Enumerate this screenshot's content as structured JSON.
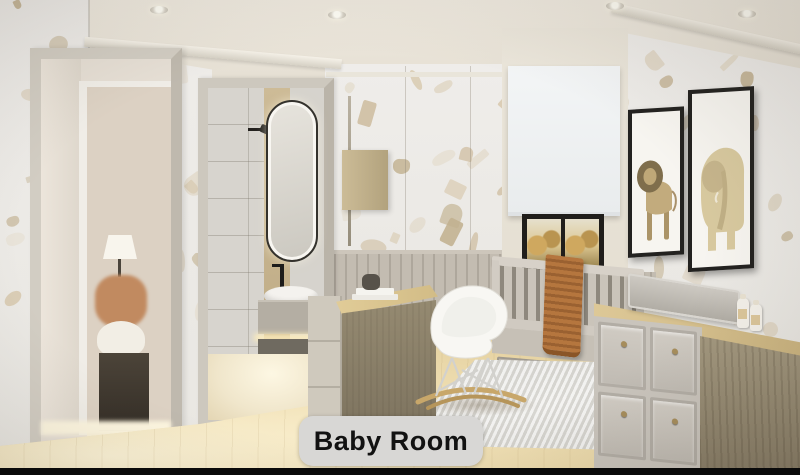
{
  "caption": {
    "label": "Baby Room"
  },
  "artworks": [
    {
      "subject": "lion"
    },
    {
      "subject": "elephant"
    }
  ],
  "scene": {
    "ceiling_lights_count": "4"
  },
  "palette": {
    "caption_bg": "#d8d7d5",
    "caption_text": "#121212",
    "bottom_bar": "#0a0a0a",
    "ceiling": "#ece7dc",
    "wall": "#edecea",
    "wainscot": "#bcb5aa",
    "floor_wood": "#e7d4a4",
    "desk_wood": "#d5bf89",
    "blanket_rust": "#b0713c",
    "frame_black": "#232220",
    "chair_white": "#f8f7f3",
    "blob_colors": [
      "#cdbc9e",
      "#d8cab0",
      "#c1b08f",
      "#e2d8c4"
    ]
  }
}
